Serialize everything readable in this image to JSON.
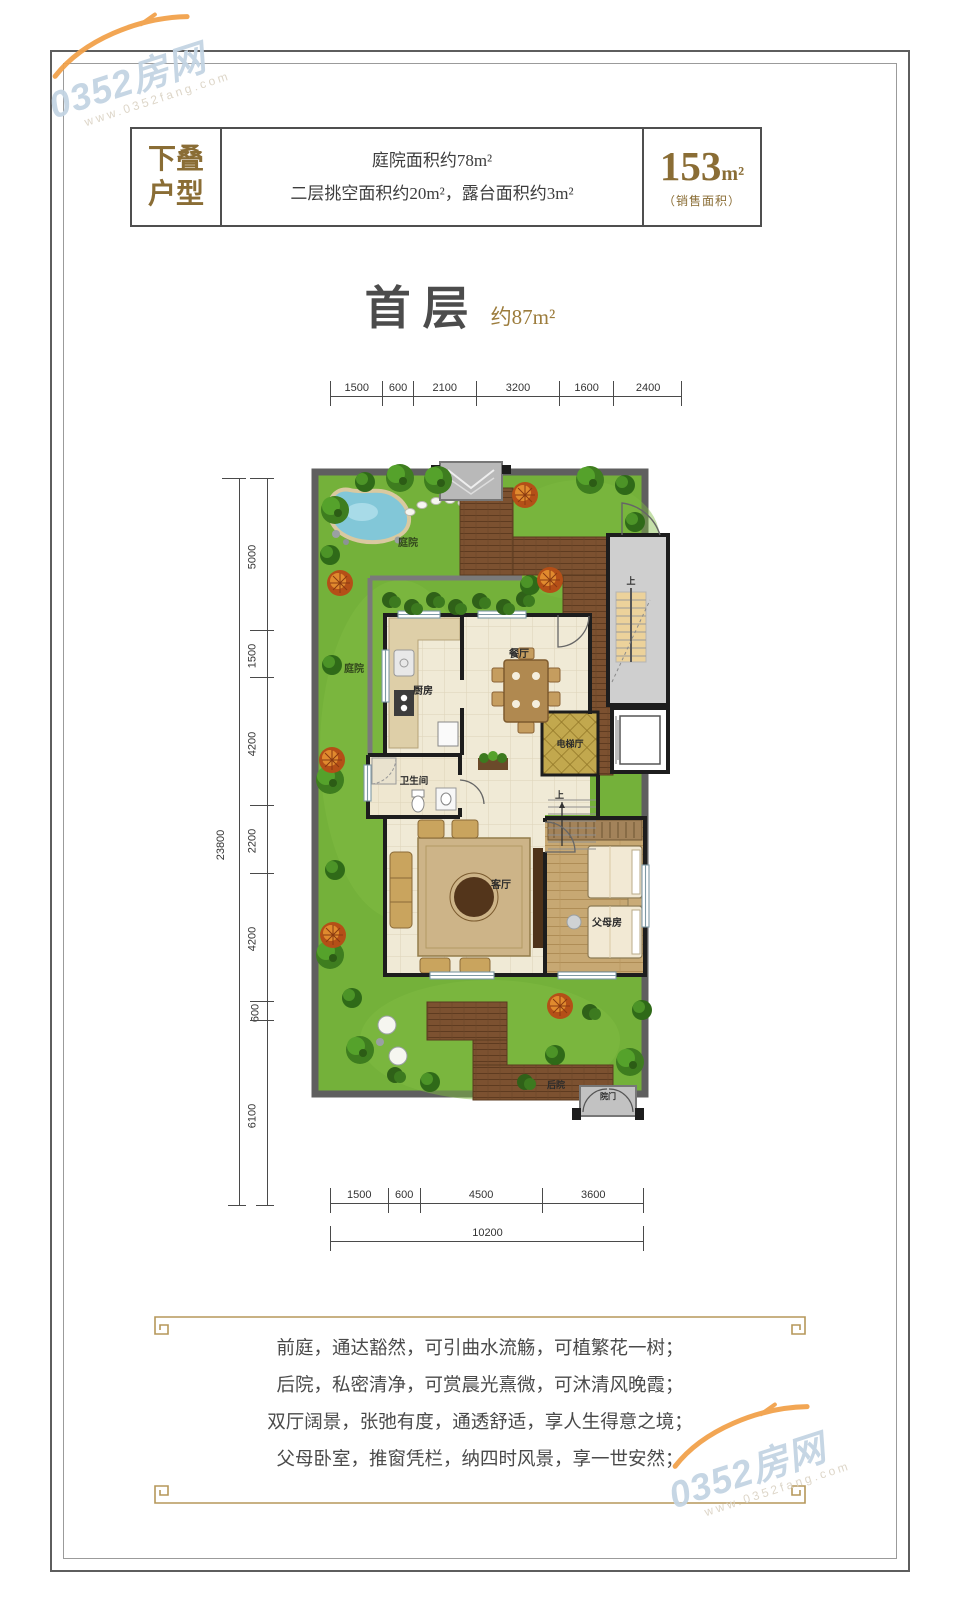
{
  "watermark": {
    "brand": "0352房网",
    "site": "www.0352fang.com"
  },
  "header": {
    "tag_line1": "下叠",
    "tag_line2": "户型",
    "info_line1": "庭院面积约78m²",
    "info_line2": "二层挑空面积约20m²，露台面积约3m²",
    "area_value": "153",
    "area_unit": "m²",
    "area_note": "（销售面积）"
  },
  "title": {
    "floor_label": "首层",
    "area_label": "约87m²"
  },
  "plan": {
    "rooms": {
      "kitchen": "厨房",
      "dining": "餐厅",
      "elevator_hall": "电梯厅",
      "bath": "卫生间",
      "living": "客厅",
      "parents": "父母房"
    },
    "garden": {
      "courtyard_top": "庭院",
      "courtyard_left": "庭院",
      "backyard": "后院",
      "gate": "院门"
    },
    "stair_up_label": "上",
    "dims": {
      "top": [
        1500,
        600,
        2100,
        3200,
        1600,
        2400
      ],
      "left": [
        5000,
        1500,
        4200,
        2200,
        4200,
        600,
        6100
      ],
      "left_total": 23800,
      "bottom": [
        1500,
        600,
        4500,
        3600
      ],
      "bottom_total": 10200
    }
  },
  "footer": {
    "lines": [
      "前庭，通达豁然，可引曲水流觞，可植繁花一树；",
      "后院，私密清净，可赏晨光熹微，可沐清风晚霞；",
      "双厅阔景，张弛有度，通透舒适，享人生得意之境；",
      "父母卧室，推窗凭栏，纳四时风景，享一世安然；"
    ]
  },
  "colors": {
    "accent_gold": "#8a6d35",
    "ornament_gold": "#b5975a",
    "wall_black": "#1d1d1d",
    "garden_green": "#74b13a",
    "deck_brown": "#7c5130",
    "watermark_blue": "#c3d4e3"
  }
}
